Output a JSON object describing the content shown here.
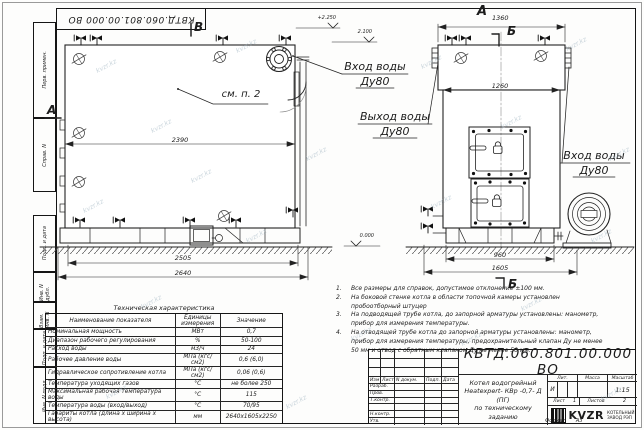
{
  "sheet": {
    "doc_number": "КВТД.060.801.00.000 ВО",
    "format_word": "Формат",
    "format_value": "А3",
    "watermark": "kvzr.kz"
  },
  "margin_stamps": {
    "items": [
      "Перв. примен.",
      "Справ. N",
      "Подп. и дата",
      "Инв. N дубл.",
      "Взам. инв. N",
      "Подп. и дата",
      "Инв. N подл."
    ]
  },
  "views": {
    "front": {
      "section_b": "В",
      "section_a": "А",
      "see_note": "см. п. 2",
      "dim_width": "2390",
      "dim_frame": "2505",
      "dim_overall": "2640",
      "elev_top": "+2.250",
      "elev_pipe": "2.100",
      "elev_ground": "0.000"
    },
    "side": {
      "view_label": "А",
      "dim_top": "1360",
      "dim_body": "1260",
      "dim_frame": "960",
      "dim_overall": "1605",
      "section_top": "Б",
      "section_bottom": "Б"
    }
  },
  "pipe_labels": {
    "inlet_front": {
      "title": "Вход воды",
      "dn": "Ду80"
    },
    "outlet": {
      "title": "Выход воды",
      "dn": "Ду80"
    },
    "inlet_side": {
      "title": "Вход воды",
      "dn": "Ду80"
    }
  },
  "notes": {
    "items": [
      {
        "n": "1.",
        "text": "Все размеры для справок, допустимое отклонение ±100 мм."
      },
      {
        "n": "2.",
        "text": "На боковой стенке котла в области топочной камеры установлен пробоотборный штуцер"
      },
      {
        "n": "3.",
        "text": "На подводящей трубе котла, до запорной арматуры установлены: манометр, прибор для измерения температуры."
      },
      {
        "n": "4.",
        "text": "На отводящей трубе котла до запорной арматуры установлены: манометр, прибор для измерения температуры, предохранительный клапан Ду не менее 50 мм и отвод с обратным клапаном Ду не менее 50 мм."
      }
    ]
  },
  "tech_table": {
    "title": "Техническая характеристика",
    "headers": {
      "name": "Наименование показателя",
      "units": "Единицы измерения",
      "value": "Значение"
    },
    "rows": [
      {
        "name": "Номинальная мощность",
        "units": "МВт",
        "value": "0,7"
      },
      {
        "name": "Диапазон рабочего регулирования",
        "units": "%",
        "value": "50-100"
      },
      {
        "name": "Расход воды",
        "units": "м3/ч",
        "value": "24"
      },
      {
        "name": "Рабочее давление воды",
        "units": "МПа (кгс/см2)",
        "value": "0,6 (6,0)"
      },
      {
        "name": "Гидравлическое сопротивление котла",
        "units": "МПа (кгс/см2)",
        "value": "0,06 (0,6)"
      },
      {
        "name": "Температура уходящих газов",
        "units": "°С",
        "value": "не более 250"
      },
      {
        "name": "Максимальная рабочая температура воды",
        "units": "°С",
        "value": "115"
      },
      {
        "name": "Температура воды (вход/выход)",
        "units": "°С",
        "value": "70/95"
      },
      {
        "name": "Габариты котла (длина х ширина х высота)",
        "units": "мм",
        "value": "2640х1605х2250"
      }
    ]
  },
  "title_block": {
    "doc_number": "КВТД.060.801.00.000  ВО",
    "rev_headers": {
      "izm": "Изм",
      "list": "Лист",
      "doc": "N докум.",
      "sign": "Подп.",
      "date": "Дата"
    },
    "rev_rows": [
      "Разраб.",
      "Пров.",
      "Т.контр.",
      "",
      "Н.контр.",
      "Утв."
    ],
    "name_line1": "Котел водогрейный",
    "name_line2": "Heatexpert- КВр -0,7- Д (ПГ)",
    "name_line3": "по техническому заданию",
    "lit_header": "Лит.",
    "mass_header": "Масса",
    "scale_header": "Масштаб",
    "lit_value": "И",
    "scale_value": "1:15",
    "sheet_label": "Лист",
    "sheet_value": "1",
    "sheets_label": "Листов",
    "sheets_value": "2",
    "logo_word": "KVZR",
    "logo_sub1": "КОТЕЛЬНЫЙ",
    "logo_sub2": "ЗАВОД РЭП"
  }
}
